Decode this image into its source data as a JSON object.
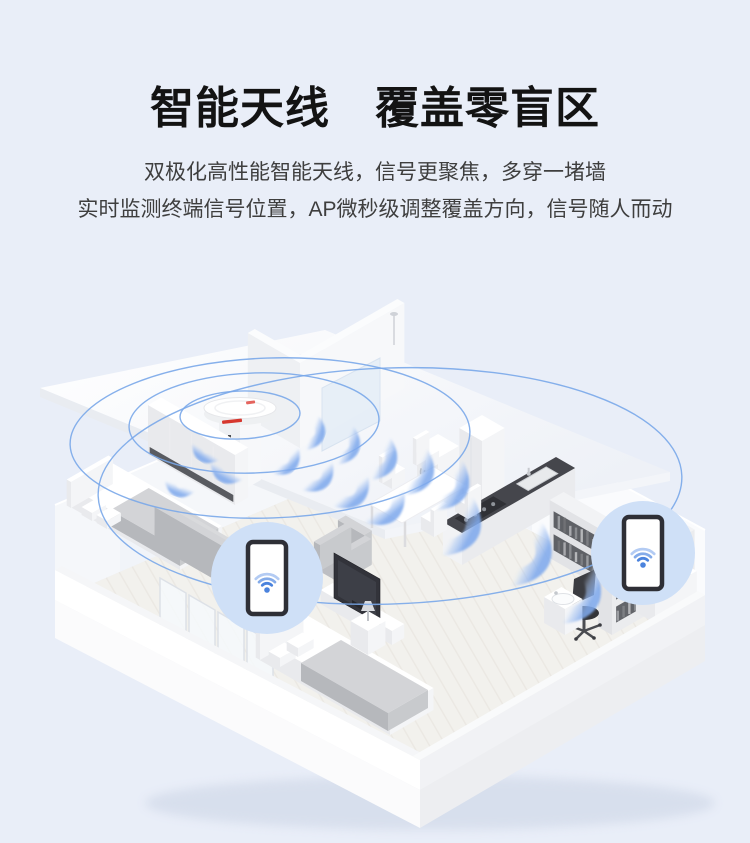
{
  "page": {
    "background_color": "#e9eef8"
  },
  "header": {
    "title": "智能天线　覆盖零盲区",
    "subtitle_line1": "双极化高性能智能天线，信号更聚焦，多穿一堵墙",
    "subtitle_line2": "实时监测终端信号位置，AP微秒级调整覆盖方向，信号随人而动"
  },
  "illustration": {
    "colors": {
      "signal_ring_blue": "#79a7e9",
      "signal_wave_blue": "#7fa9ec",
      "badge_circle_blue": "#cfe0f7",
      "wifi_glyph_blue": "#4b83dd",
      "ap_accent_red": "#d6372e"
    },
    "icons": {
      "transmitter": "ceiling-ap-device",
      "left_device": "smartphone-wifi-icon",
      "right_device": "smartphone-wifi-icon",
      "signal": "wifi-wave-icon"
    }
  }
}
